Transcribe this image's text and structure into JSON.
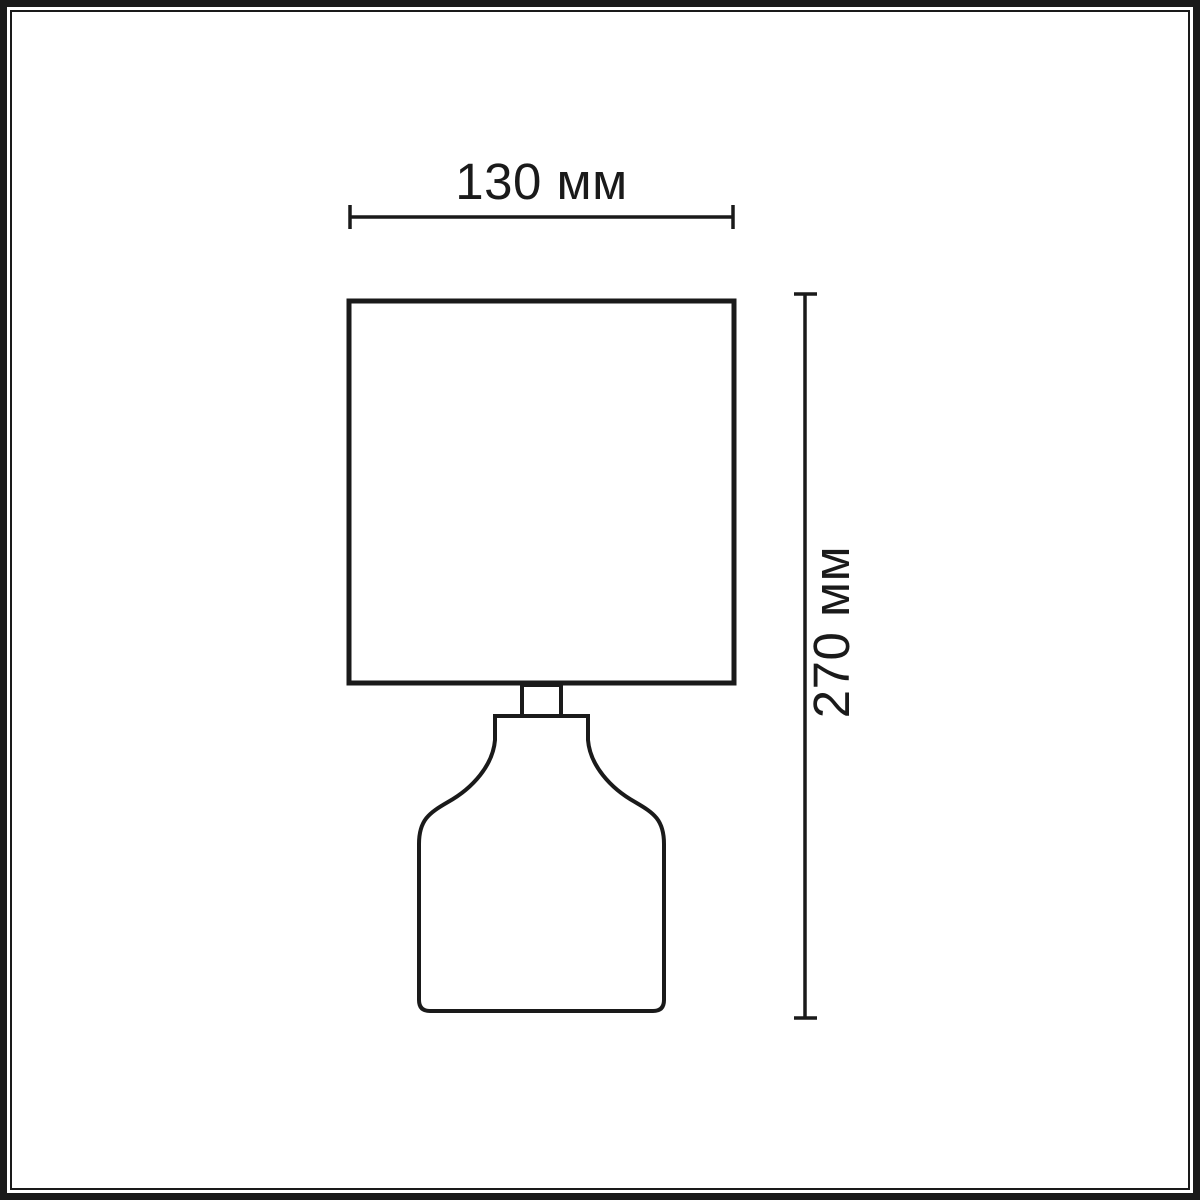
{
  "diagram": {
    "name": "table-lamp-dimension-drawing",
    "background_color": "#ffffff",
    "line_color": "#1a1a1a",
    "width_dimension": {
      "axis": "width",
      "label": "130 мм",
      "value": 130,
      "unit": "мм"
    },
    "height_dimension": {
      "axis": "height",
      "label": "270 мм",
      "value": 270,
      "unit": "мм"
    }
  }
}
